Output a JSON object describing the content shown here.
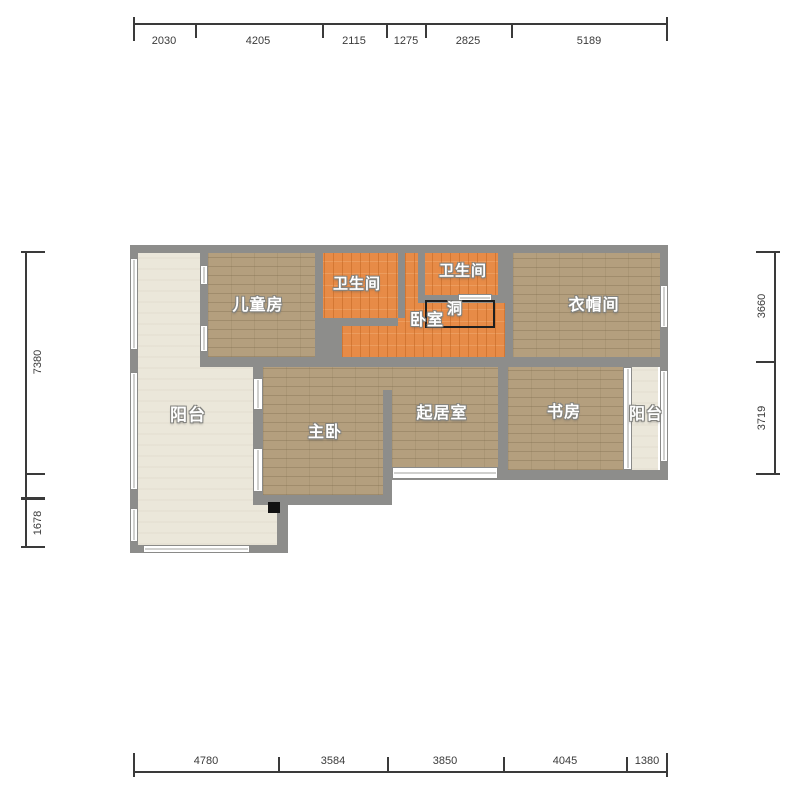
{
  "rooms": {
    "balcony_left": "阳台",
    "children_room": "儿童房",
    "bathroom_left": "卫生间",
    "bathroom_right": "卫生间",
    "bedroom": "卧室",
    "hole": "洞",
    "cloakroom": "衣帽间",
    "master_bedroom": "主卧",
    "living_room": "起居室",
    "study": "书房",
    "balcony_right": "阳台"
  },
  "dimensions": {
    "top": [
      "2030",
      "4205",
      "2115",
      "1275",
      "2825",
      "5189"
    ],
    "bottom": [
      "4780",
      "3584",
      "3850",
      "4045",
      "1380"
    ],
    "left": [
      "7380",
      "1678"
    ],
    "right": [
      "3660",
      "3719"
    ]
  },
  "colors": {
    "wall": "#8d8d8b",
    "floor_wood_tan": "#b49f7e",
    "floor_wood_orange": "#e78b47",
    "floor_balcony": "#ebe7da",
    "dimension_text": "#3a3a3a"
  }
}
